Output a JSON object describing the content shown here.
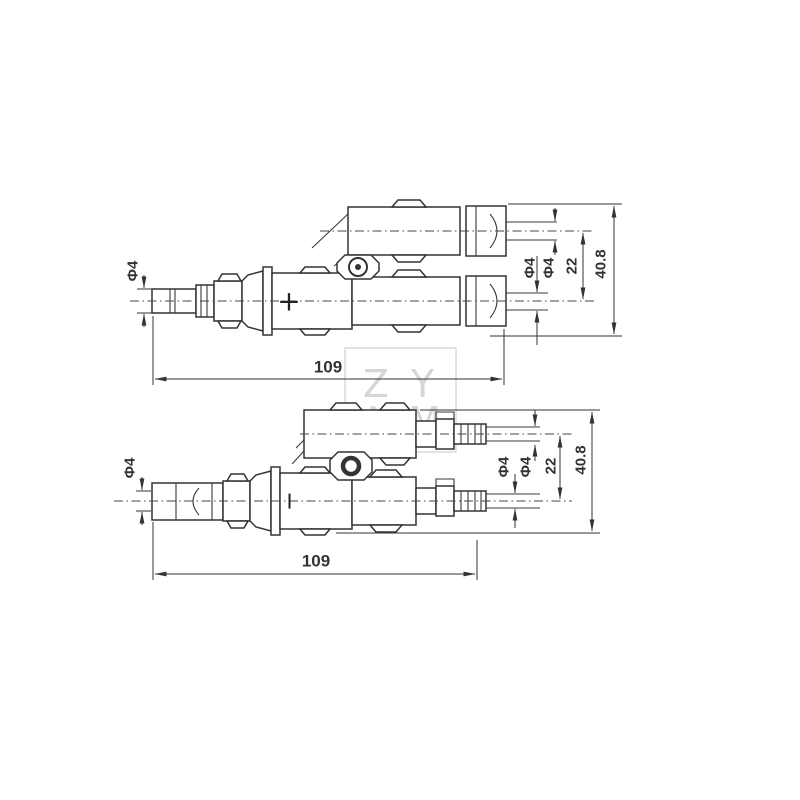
{
  "watermark": {
    "line1": "Z Y",
    "line2": "A M"
  },
  "diagram_top": {
    "polarity_mark": "+",
    "dim_left_cable_diameter": "Φ4",
    "dim_branch_cable_diameter_1": "Φ4",
    "dim_branch_cable_diameter_2": "Φ4",
    "dim_branch_center_spacing": "22",
    "dim_overall_height": "40.8",
    "dim_overall_length": "109"
  },
  "diagram_bottom": {
    "polarity_mark": "−",
    "dim_left_cable_diameter": "Φ4",
    "dim_branch_cable_diameter_1": "Φ4",
    "dim_branch_cable_diameter_2": "Φ4",
    "dim_branch_center_spacing": "22",
    "dim_overall_height": "40.8",
    "dim_overall_length": "109"
  }
}
